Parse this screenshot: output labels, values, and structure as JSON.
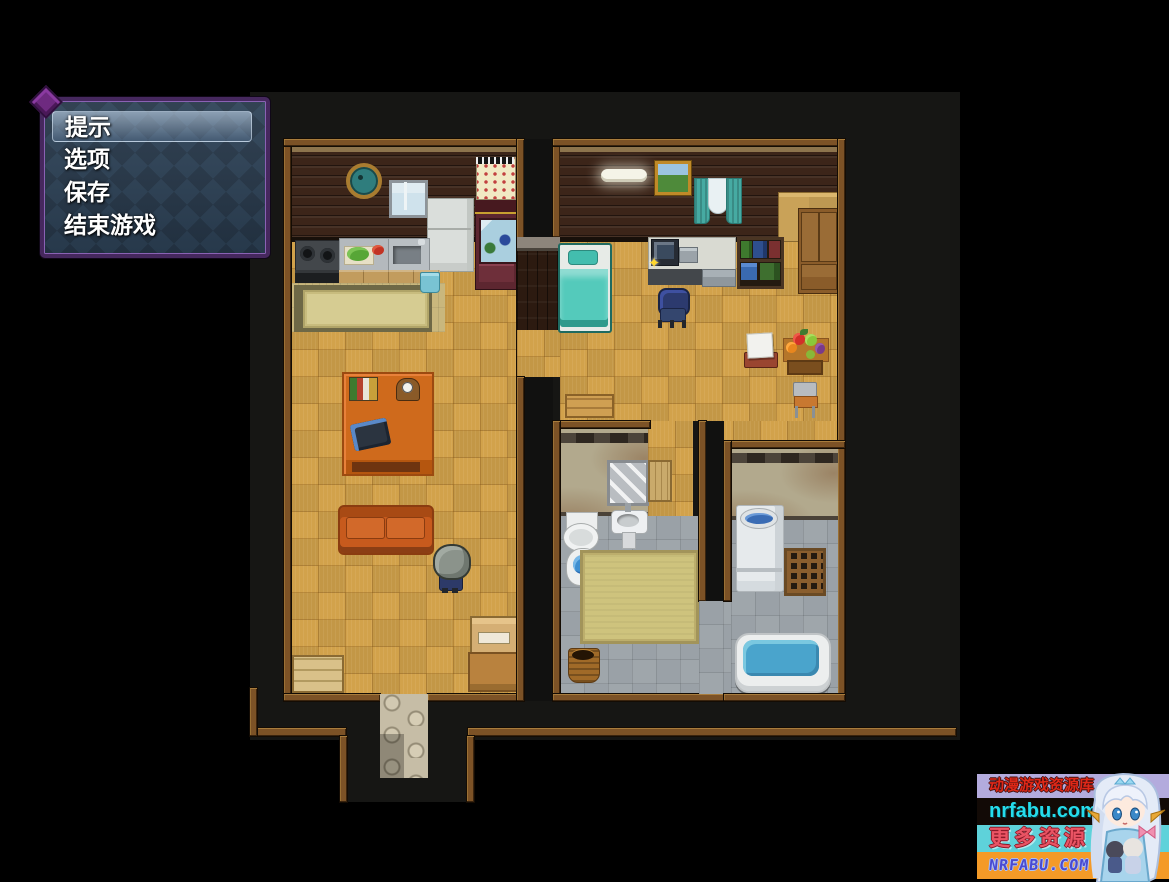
{
  "window_menu": {
    "items": [
      {
        "label": "提示"
      },
      {
        "label": "选项"
      },
      {
        "label": "保存"
      },
      {
        "label": "结束游戏"
      }
    ],
    "selected_index": 0
  },
  "watermark": {
    "line1": "动漫游戏资源库",
    "line2": "nrfabu.com",
    "line3": "更多资源",
    "line4": "NRFABU.COM"
  },
  "colors": {
    "menu_window_bg": "#2d4257",
    "menu_border": "#46285e",
    "menu_highlight": "#c3d7eb",
    "floor_parquet": "#d2a24b",
    "wall_dark_wood": "#3c2519",
    "wall_bathroom": "#b2a98d",
    "frame_trim": "#7c5226",
    "bed_blanket": "#54cabb",
    "sofa": "#c75a1d",
    "bath_water": "#4aa4cc",
    "watermark_row1_bg": "#b3abdd",
    "watermark_row1_text": "#e02818",
    "watermark_row2_bg": "#120a06",
    "watermark_row2_text": "#25dcec",
    "watermark_row3_bg": "#5ed2da",
    "watermark_row3_text": "#ea5464",
    "watermark_row4_bg": "#f49a27",
    "watermark_row4_text": "#4a4ad0"
  }
}
